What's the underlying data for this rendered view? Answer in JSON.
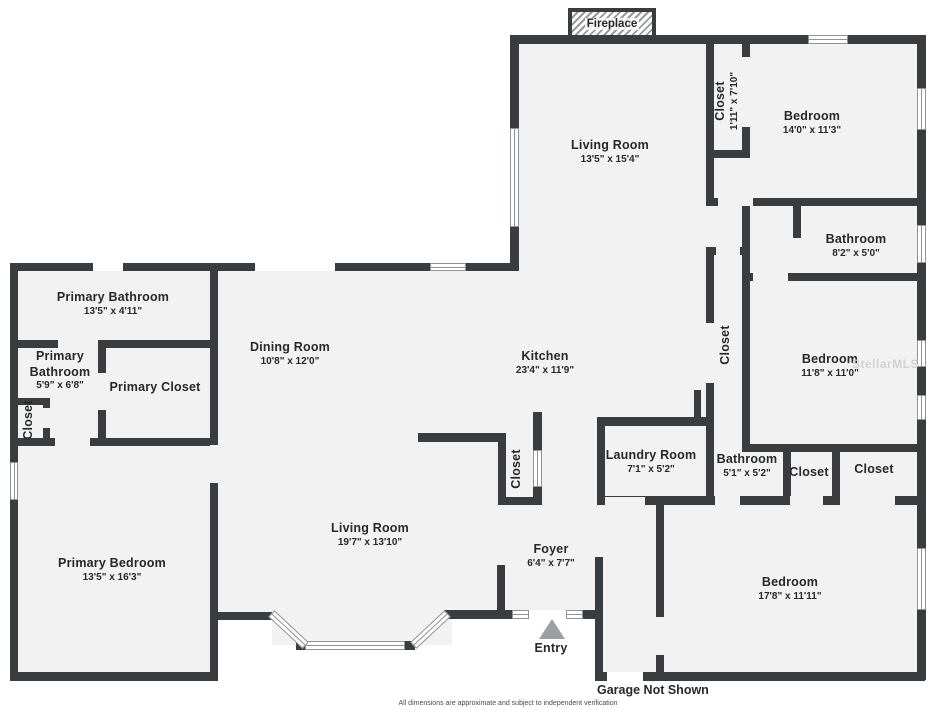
{
  "colors": {
    "wall": "#3a3d3f",
    "floor": "#f2f2f2",
    "background": "#ffffff",
    "text": "#26282a"
  },
  "fireplace": {
    "label": "Fireplace"
  },
  "entry": {
    "label": "Entry"
  },
  "garage_note": "Garage Not Shown",
  "disclaimer": "All dimensions are approximate and subject to independent verification",
  "watermark": "StellarMLS",
  "rooms": {
    "living_top": {
      "name": "Living Room",
      "dims": "13'5\" x 15'4\""
    },
    "closet_top": {
      "name": "Closet",
      "dims": "1'11\" x 7'10\""
    },
    "bedroom_top": {
      "name": "Bedroom",
      "dims": "14'0\" x 11'3\""
    },
    "bathroom_right": {
      "name": "Bathroom",
      "dims": "8'2\" x 5'0\""
    },
    "closet_hall": {
      "name": "Closet"
    },
    "bedroom_mid": {
      "name": "Bedroom",
      "dims": "11'8\" x 11'0\""
    },
    "primary_bathroom": {
      "name": "Primary Bathroom",
      "dims": "13'5\" x 4'11\""
    },
    "primary_bathroom_2": {
      "name": "Primary Bathroom",
      "dims": "5'9\" x 6'8\""
    },
    "primary_closet": {
      "name": "Primary Closet"
    },
    "closet_left": {
      "name": "Closet"
    },
    "dining": {
      "name": "Dining Room",
      "dims": "10'8\" x 12'0\""
    },
    "kitchen": {
      "name": "Kitchen",
      "dims": "23'4\" x 11'9\""
    },
    "closet_kitchen": {
      "name": "Closet"
    },
    "laundry": {
      "name": "Laundry Room",
      "dims": "7'1\" x 5'2\""
    },
    "bathroom_small": {
      "name": "Bathroom",
      "dims": "5'1\" x 5'2\""
    },
    "closet_1": {
      "name": "Closet"
    },
    "closet_2": {
      "name": "Closet"
    },
    "bedroom_bottom": {
      "name": "Bedroom",
      "dims": "17'8\" x 11'11\""
    },
    "primary_bedroom": {
      "name": "Primary Bedroom",
      "dims": "13'5\" x 16'3\""
    },
    "living_bottom": {
      "name": "Living Room",
      "dims": "19'7\" x 13'10\""
    },
    "foyer": {
      "name": "Foyer",
      "dims": "6'4\" x 7'7\""
    }
  }
}
